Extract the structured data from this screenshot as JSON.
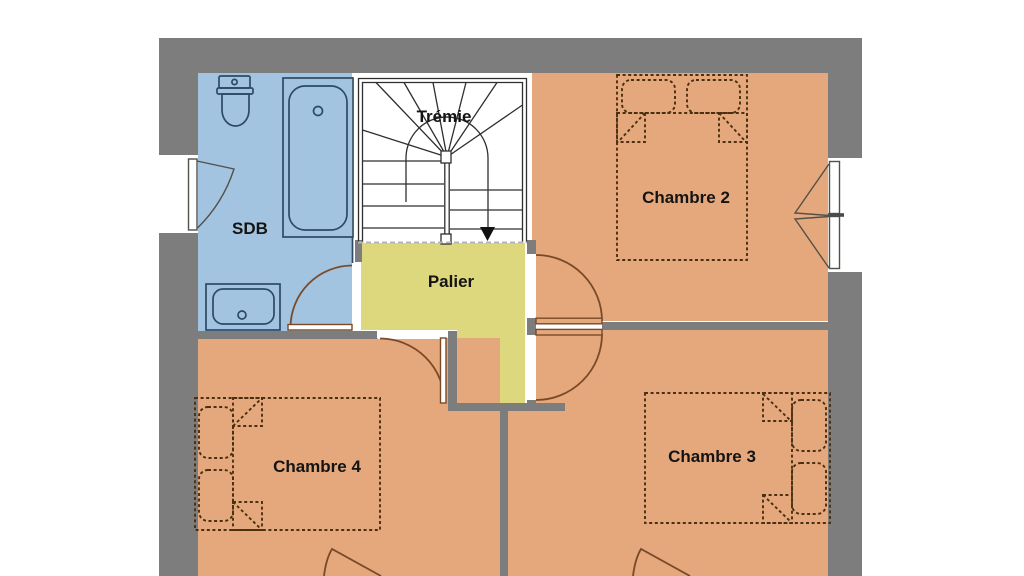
{
  "title": "Plan d'étage",
  "colors": {
    "background": "#ffffff",
    "wall": "#7d7d7d",
    "bathroom": "#a3c4e0",
    "bedroom": "#e4a87c",
    "landing": "#ddd77e",
    "stairwell": "#ffffff",
    "fixture_line": "#2c4a66",
    "stair_line": "#2f2f2f",
    "door_line": "#7a4a28",
    "bed_line": "#4a2f12",
    "window_line": "#54504a",
    "label": "#141414"
  },
  "rooms": {
    "bathroom": {
      "label": "SDB"
    },
    "stairwell": {
      "label": "Trémie"
    },
    "landing": {
      "label": "Palier"
    },
    "bedroom2": {
      "label": "Chambre 2"
    },
    "bedroom3": {
      "label": "Chambre 3"
    },
    "bedroom4": {
      "label": "Chambre 4"
    }
  }
}
